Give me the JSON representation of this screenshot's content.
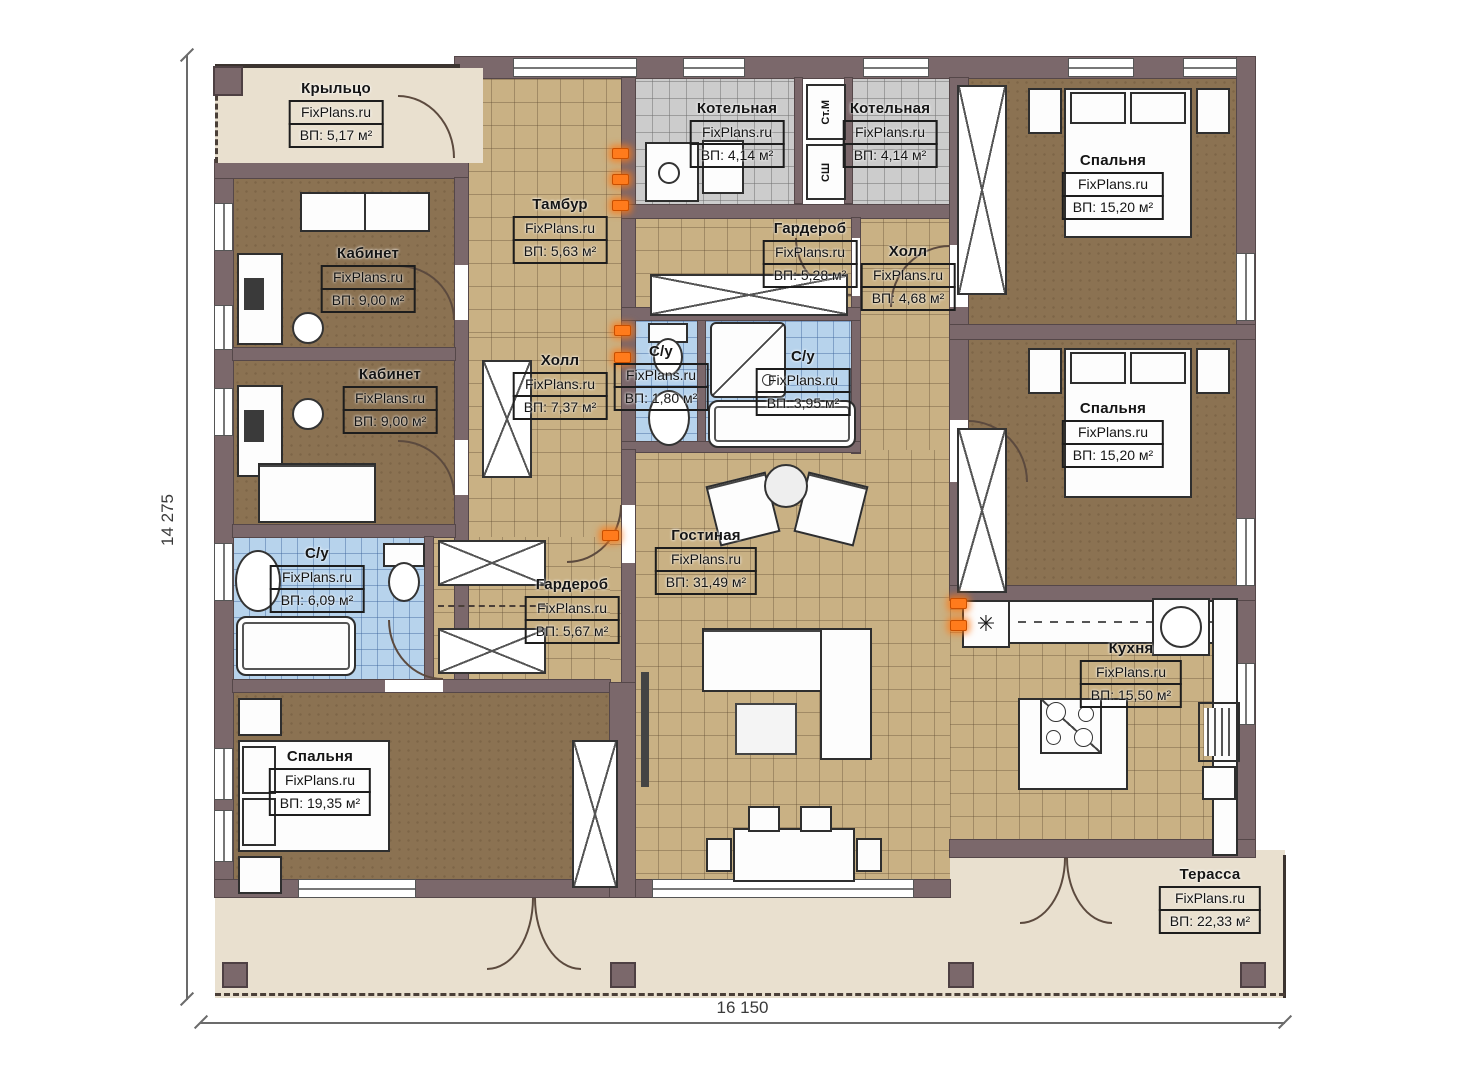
{
  "plan": {
    "watermark": "FixPlans.ru",
    "dimensions": {
      "width_label": "16 150",
      "height_label": "14 275"
    },
    "appliances": {
      "washer": "Ст.М",
      "dryer": "СШ"
    },
    "icons": {
      "kitchen_vent_glyph": "✳"
    },
    "colors": {
      "wall": "#7b686b",
      "tile_tan": "#c9b184",
      "floor_brown": "#8b7252",
      "tile_blue": "#b7d3ec",
      "tile_gray": "#cccccc",
      "outdoor_beige": "#e9e0cf",
      "accent_orange": "#ff7b1c"
    },
    "rooms": [
      {
        "id": "porch",
        "name": "Крыльцо",
        "area": "ВП: 5,17 м²"
      },
      {
        "id": "tambour",
        "name": "Тамбур",
        "area": "ВП: 5,63 м²"
      },
      {
        "id": "boiler1",
        "name": "Котельная",
        "area": "ВП: 4,14 м²"
      },
      {
        "id": "boiler2",
        "name": "Котельная",
        "area": "ВП: 4,14 м²"
      },
      {
        "id": "bedroom1",
        "name": "Спальня",
        "area": "ВП: 15,20 м²"
      },
      {
        "id": "wardrobe1",
        "name": "Гардероб",
        "area": "ВП: 5,28 м²"
      },
      {
        "id": "hall1",
        "name": "Холл",
        "area": "ВП: 4,68 м²"
      },
      {
        "id": "office1",
        "name": "Кабинет",
        "area": "ВП: 9,00 м²"
      },
      {
        "id": "office2",
        "name": "Кабинет",
        "area": "ВП: 9,00 м²"
      },
      {
        "id": "hall2",
        "name": "Холл",
        "area": "ВП: 7,37 м²"
      },
      {
        "id": "wc1",
        "name": "С/у",
        "area": "ВП: 1,80 м²"
      },
      {
        "id": "wc2",
        "name": "С/у",
        "area": "ВП: 3,95 м²"
      },
      {
        "id": "bedroom2",
        "name": "Спальня",
        "area": "ВП: 15,20 м²"
      },
      {
        "id": "wc3",
        "name": "С/у",
        "area": "ВП: 6,09 м²"
      },
      {
        "id": "wardrobe2",
        "name": "Гардероб",
        "area": "ВП: 5,67 м²"
      },
      {
        "id": "living",
        "name": "Гостиная",
        "area": "ВП: 31,49 м²"
      },
      {
        "id": "bedroom3",
        "name": "Спальня",
        "area": "ВП: 19,35 м²"
      },
      {
        "id": "kitchen",
        "name": "Кухня",
        "area": "ВП: 15,50 м²"
      },
      {
        "id": "terrace",
        "name": "Терасса",
        "area": "ВП: 22,33 м²"
      }
    ]
  }
}
